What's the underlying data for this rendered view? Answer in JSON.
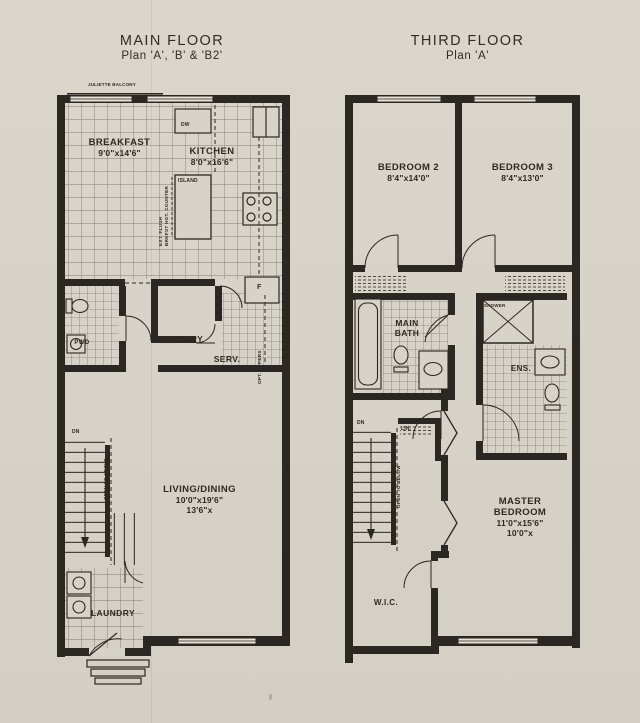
{
  "colors": {
    "paper": "#d7d3c9",
    "ink": "#2b2722"
  },
  "main_floor": {
    "title": "MAIN FLOOR",
    "subtitle": "Plan 'A', 'B' & 'B2'",
    "balcony": "JULIETTE BALCONY",
    "rooms": {
      "breakfast": {
        "name": "BREAKFAST",
        "dims": "9'0\"x14'6\""
      },
      "kitchen": {
        "name": "KITCHEN",
        "dims": "8'0\"x16'6\""
      },
      "pwd": {
        "name": "PWD"
      },
      "pantry": {
        "name": "PANTRY"
      },
      "serv": {
        "name": "SERV."
      },
      "living": {
        "name": "LIVING/DINING",
        "dims": "10'0\"x19'6\"",
        "dims2": "13'6\"x"
      },
      "laundry": {
        "name": "LAUNDRY"
      }
    },
    "annotations": {
      "island": "ISLAND",
      "dw": "DW",
      "fridge": "F",
      "opt_uppers": "OPT. UPPERS",
      "ext_flush": "EXT. FLUSH",
      "brkfst_bar": "BRKFST HGT. COUNTER",
      "dn": "DN",
      "open_to_above": "OPEN TO ABOVE"
    }
  },
  "third_floor": {
    "title": "THIRD FLOOR",
    "subtitle": "Plan 'A'",
    "rooms": {
      "bedroom2": {
        "name": "BEDROOM 2",
        "dims": "8'4\"x14'0\""
      },
      "bedroom3": {
        "name": "BEDROOM 3",
        "dims": "8'4\"x13'0\""
      },
      "main_bath": {
        "name": "MAIN BATH"
      },
      "ens": {
        "name": "ENS."
      },
      "master": {
        "name": "MASTER BEDROOM",
        "dims": "11'0\"x15'6\"",
        "dims2": "10'0\"x"
      },
      "wic": {
        "name": "W.I.C."
      }
    },
    "annotations": {
      "shower": "SHOWER",
      "lin": "LIN.",
      "dn": "DN",
      "open_to_below": "OPEN TO BELOW"
    }
  }
}
